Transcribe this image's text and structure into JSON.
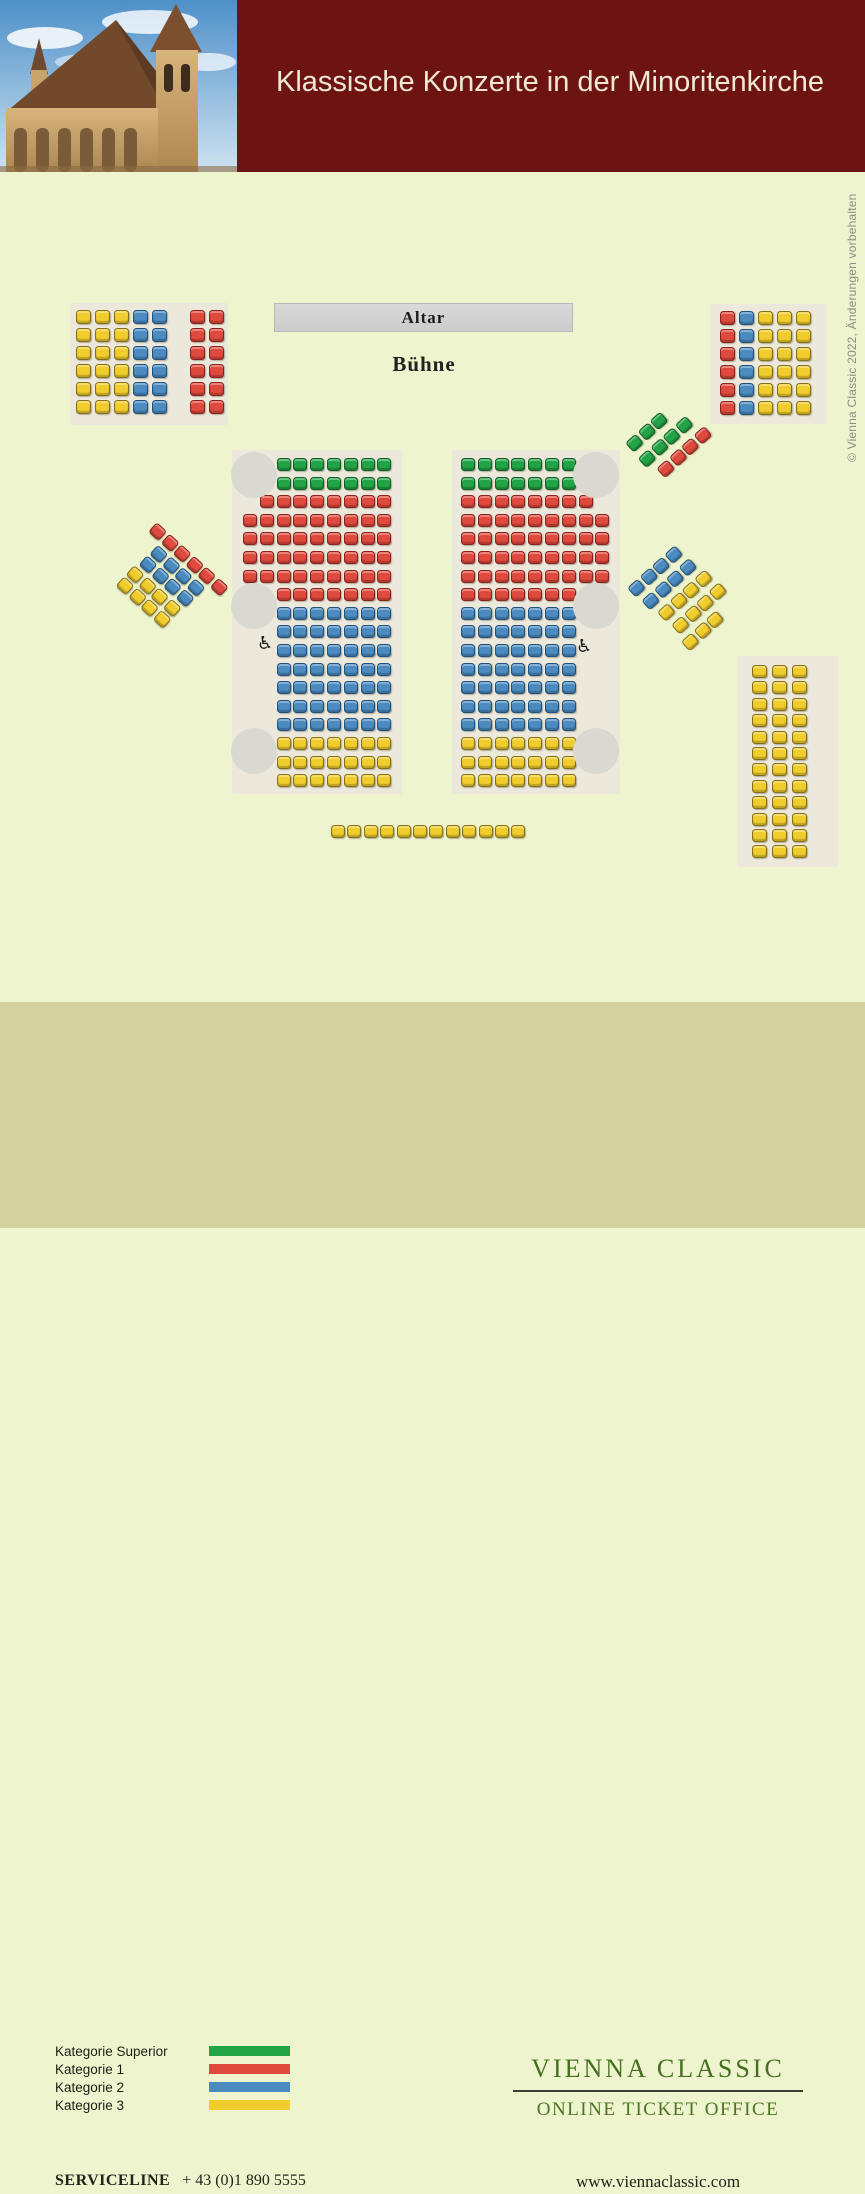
{
  "header": {
    "title": "Klassische Konzerte in der Minoritenkirche"
  },
  "stage": {
    "altar_label": "Altar",
    "buehne_label": "Bühne"
  },
  "copyright": "© Vienna Classic 2022, Änderungen vorbehalten",
  "legend": {
    "items": [
      {
        "label": "Kategorie Superior",
        "key": "superior"
      },
      {
        "label": "Kategorie 1",
        "key": "kat1"
      },
      {
        "label": "Kategorie 2",
        "key": "kat2"
      },
      {
        "label": "Kategorie 3",
        "key": "kat3"
      }
    ]
  },
  "brand": {
    "name": "VIENNA CLASSIC",
    "tagline": "ONLINE TICKET OFFICE"
  },
  "contact": {
    "serviceline_label": "SERVICELINE",
    "phone": "+ 43 (0)1 890 5555",
    "website": "www.viennaclassic.com"
  },
  "colors": {
    "superior": "#22a446",
    "kat1": "#df4a3e",
    "kat2": "#4b8bc0",
    "kat3": "#f0cd2d",
    "header_bg": "#6d1413",
    "page_bg": "#eef4cd",
    "footer_bg": "#d2d2a0",
    "panel_bg": "#ece8db",
    "pillar": "#d9d9d1",
    "brand_green": "#44701f"
  },
  "seat_map": {
    "wheelchair_glyph": "♿",
    "blocks": [
      {
        "name": "gallery-left-block",
        "left": 70,
        "top": 303,
        "width": 158,
        "height": 122,
        "panel": true,
        "pad_x": 6,
        "pad_y": 7,
        "pitch_x": 19,
        "pitch_y": 18,
        "seat_w": 15,
        "seat_h": 14,
        "rows": [
          "yyybb_rr",
          "yyybb_rr",
          "yyybb_rr",
          "yyybb_rr",
          "yyybb_rr",
          "yyybb_rr"
        ]
      },
      {
        "name": "gallery-right-block",
        "left": 710,
        "top": 304,
        "width": 117,
        "height": 120,
        "panel": true,
        "pad_x": 10,
        "pad_y": 7,
        "pitch_x": 19,
        "pitch_y": 18,
        "seat_w": 15,
        "seat_h": 14,
        "rows": [
          "rbyyy",
          "rbyyy",
          "rbyyy",
          "rbyyy",
          "rbyyy",
          "rbyyy"
        ]
      },
      {
        "name": "nave-left-block",
        "left": 232,
        "top": 450,
        "width": 170,
        "height": 344,
        "panel": true,
        "pad_x": 11,
        "pad_y": 8,
        "pitch_x": 16.8,
        "pitch_y": 18.6,
        "seat_w": 14,
        "seat_h": 13,
        "rows": [
          "__ggggggg",
          "__ggggggg",
          "_rrrrrrrr",
          "rrrrrrrrr",
          "rrrrrrrrr",
          "rrrrrrrrr",
          "rrrrrrrrr",
          "__rrrrrrr",
          "__bbbbbbb",
          "__bbbbbbb",
          "__bbbbbbb",
          "__bbbbbbb",
          "__bbbbbbb",
          "__bbbbbbb",
          "__bbbbbbb",
          "__yyyyyyy",
          "__yyyyyyy",
          "__yyyyyyy"
        ]
      },
      {
        "name": "nave-right-block",
        "left": 452,
        "top": 450,
        "width": 168,
        "height": 344,
        "panel": true,
        "pad_x": 9,
        "pad_y": 8,
        "pitch_x": 16.8,
        "pitch_y": 18.6,
        "seat_w": 14,
        "seat_h": 13,
        "rows": [
          "ggggggg",
          "ggggggg",
          "rrrrrrrr",
          "rrrrrrrrr",
          "rrrrrrrrr",
          "rrrrrrrrr",
          "rrrrrrrrr",
          "rrrrrrr",
          "bbbbbbb",
          "bbbbbbb",
          "bbbbbbb",
          "bbbbbbb",
          "bbbbbbb",
          "bbbbbbb",
          "bbbbbbb",
          "yyyyyyy",
          "yyyyyyy",
          "yyyyyyy"
        ]
      },
      {
        "name": "side-left-diagonal-block",
        "left": 130,
        "top": 498,
        "rotate": 42,
        "panel": false,
        "pitch_x": 16.5,
        "pitch_y": 15.5,
        "seat_w": 14,
        "seat_h": 13,
        "rows": [
          {
            "s": "rrrrrr",
            "dx": 36
          },
          {
            "s": "bbbb",
            "dx": 52
          },
          {
            "s": "bbbb",
            "dx": 51
          },
          {
            "s": "yyyy",
            "dx": 48
          },
          {
            "s": "yyyy",
            "dx": 48
          }
        ]
      },
      {
        "name": "choir-upper-diagonal-block",
        "left": 625,
        "top": 443,
        "rotate": -42,
        "panel": false,
        "pitch_x": 16.5,
        "pitch_y": 20,
        "seat_w": 14,
        "seat_h": 13,
        "rows": [
          {
            "s": "ggg",
            "dx": 0
          },
          {
            "s": "gggg",
            "dx": -1
          },
          {
            "s": "rrrr",
            "dx": 6
          }
        ]
      },
      {
        "name": "side-right-diagonal-block",
        "left": 627,
        "top": 588,
        "rotate": -42,
        "panel": false,
        "pitch_x": 16.5,
        "pitch_y": 19,
        "seat_w": 14,
        "seat_h": 13,
        "rows": [
          {
            "s": "bbbb",
            "dx": 0
          },
          {
            "s": "bbbb",
            "dx": 2
          },
          {
            "s": "yyyy",
            "dx": 6
          },
          {
            "s": "yyyy",
            "dx": 8
          },
          {
            "s": "yyy",
            "dx": 4
          }
        ]
      },
      {
        "name": "rear-right-block",
        "left": 737,
        "top": 656,
        "width": 101,
        "height": 211,
        "panel": true,
        "pad_x": 15,
        "pad_y": 9,
        "pitch_x": 20,
        "pitch_y": 16.4,
        "seat_w": 15,
        "seat_h": 13,
        "rows": [
          "yyy",
          "yyy",
          "yyy",
          "yyy",
          "yyy",
          "yyy",
          "yyy",
          "yyy",
          "yyy",
          "yyy",
          "yyy",
          "yyy"
        ]
      },
      {
        "name": "rear-center-row",
        "left": 331,
        "top": 825,
        "panel": false,
        "pitch_x": 16.4,
        "pitch_y": 16,
        "seat_w": 14,
        "seat_h": 13,
        "rows": [
          "yyyyyyyyyyyy"
        ]
      }
    ],
    "pillars": [
      {
        "x": 231,
        "y": 452,
        "d": 46
      },
      {
        "x": 231,
        "y": 583,
        "d": 46
      },
      {
        "x": 231,
        "y": 728,
        "d": 46
      },
      {
        "x": 573,
        "y": 452,
        "d": 46
      },
      {
        "x": 573,
        "y": 583,
        "d": 46
      },
      {
        "x": 573,
        "y": 728,
        "d": 46
      }
    ],
    "wheelchairs": [
      {
        "x": 257,
        "y": 635
      },
      {
        "x": 576,
        "y": 638
      }
    ]
  }
}
